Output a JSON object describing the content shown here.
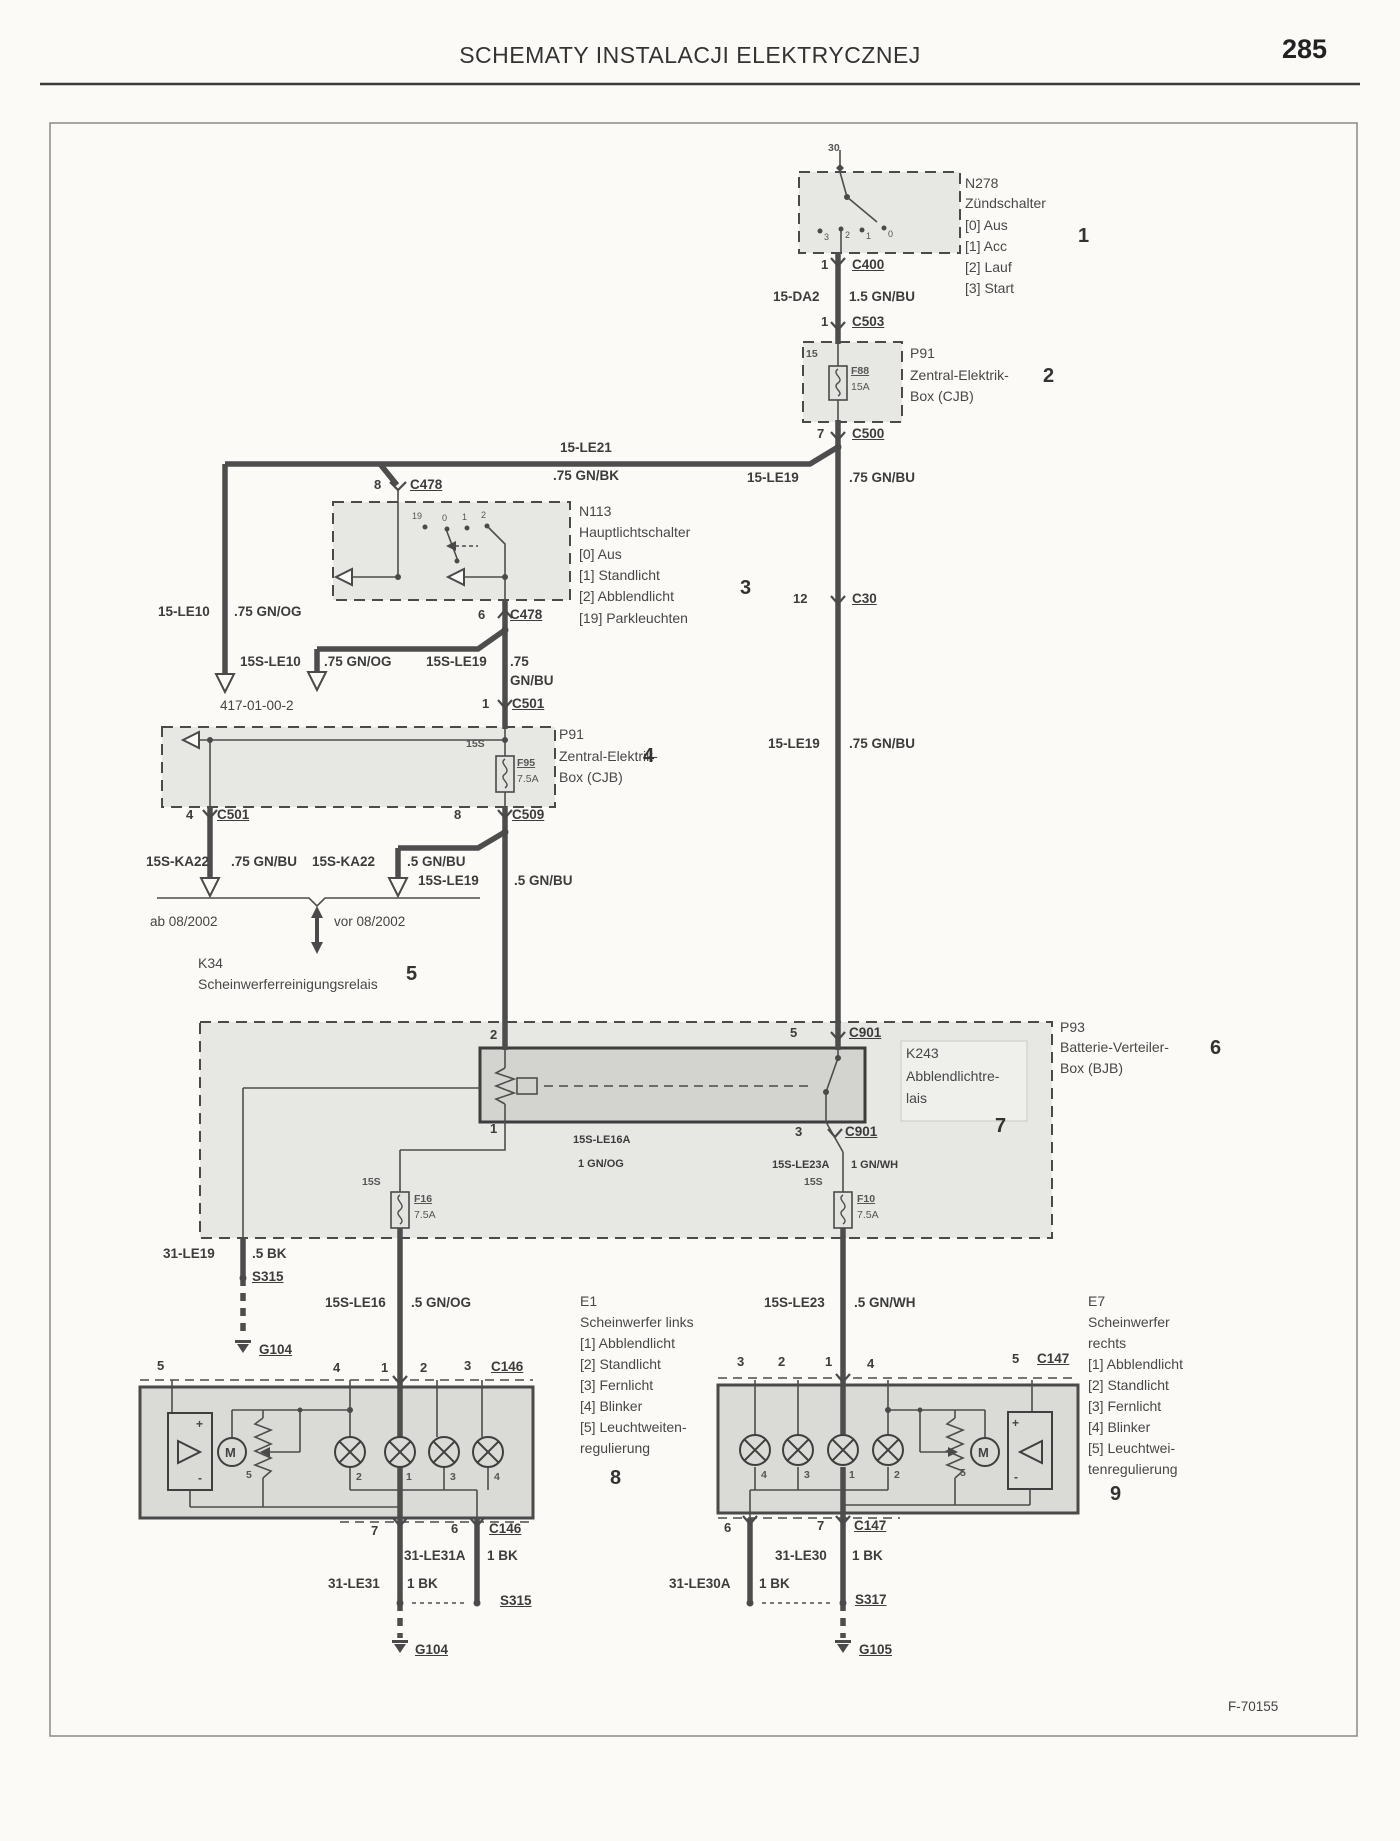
{
  "labels": {
    "header": [
      {
        "t": "SCHEMATY INSTALACJI ELEKTRYCZNEJ",
        "x": 690,
        "y": 44,
        "c": "title",
        "n": "page-header-title"
      },
      {
        "t": "285",
        "x": 1282,
        "y": 36,
        "c": "pagenum",
        "n": "page-number"
      },
      {
        "t": "F-70155",
        "x": 1228,
        "y": 1700,
        "c": "nt",
        "n": "figure-code"
      }
    ],
    "wires": [
      {
        "t": "15-DA2",
        "x": 773,
        "y": 290
      },
      {
        "t": "1.5 GN/BU",
        "x": 849,
        "y": 290
      },
      {
        "t": "15-LE21",
        "x": 560,
        "y": 441
      },
      {
        "t": ".75 GN/BK",
        "x": 553,
        "y": 469
      },
      {
        "t": "15-LE19",
        "x": 747,
        "y": 471
      },
      {
        "t": ".75 GN/BU",
        "x": 849,
        "y": 471
      },
      {
        "t": "15-LE10",
        "x": 158,
        "y": 605
      },
      {
        "t": ".75 GN/OG",
        "x": 234,
        "y": 605
      },
      {
        "t": "15S-LE10",
        "x": 240,
        "y": 655
      },
      {
        "t": ".75 GN/OG",
        "x": 324,
        "y": 655
      },
      {
        "t": "15S-LE19",
        "x": 426,
        "y": 655
      },
      {
        "t": ".75",
        "x": 510,
        "y": 655
      },
      {
        "t": "GN/BU",
        "x": 510,
        "y": 674
      },
      {
        "t": "15S-KA22",
        "x": 146,
        "y": 855
      },
      {
        "t": ".75 GN/BU",
        "x": 231,
        "y": 855
      },
      {
        "t": "15S-KA22",
        "x": 312,
        "y": 855
      },
      {
        "t": ".5 GN/BU",
        "x": 407,
        "y": 855
      },
      {
        "t": "15S-LE19",
        "x": 418,
        "y": 874
      },
      {
        "t": ".5 GN/BU",
        "x": 514,
        "y": 874
      },
      {
        "t": "15-LE19",
        "x": 768,
        "y": 737
      },
      {
        "t": ".75 GN/BU",
        "x": 849,
        "y": 737
      },
      {
        "t": "15S-LE16A",
        "x": 573,
        "y": 1135,
        "c": "wls"
      },
      {
        "t": "1 GN/OG",
        "x": 578,
        "y": 1159,
        "c": "wls"
      },
      {
        "t": "15S-LE23A",
        "x": 772,
        "y": 1160,
        "c": "wls"
      },
      {
        "t": "1 GN/WH",
        "x": 851,
        "y": 1160,
        "c": "wls"
      },
      {
        "t": "31-LE19",
        "x": 163,
        "y": 1247
      },
      {
        "t": ".5 BK",
        "x": 252,
        "y": 1247
      },
      {
        "t": "15S-LE16",
        "x": 325,
        "y": 1296
      },
      {
        "t": ".5 GN/OG",
        "x": 411,
        "y": 1296
      },
      {
        "t": "15S-LE23",
        "x": 764,
        "y": 1296
      },
      {
        "t": ".5 GN/WH",
        "x": 854,
        "y": 1296
      },
      {
        "t": "31-LE31A",
        "x": 404,
        "y": 1549
      },
      {
        "t": "1 BK",
        "x": 487,
        "y": 1549
      },
      {
        "t": "31-LE31",
        "x": 328,
        "y": 1577
      },
      {
        "t": "1 BK",
        "x": 407,
        "y": 1577
      },
      {
        "t": "31-LE30",
        "x": 775,
        "y": 1549
      },
      {
        "t": "1 BK",
        "x": 852,
        "y": 1549
      },
      {
        "t": "31-LE30A",
        "x": 669,
        "y": 1577
      },
      {
        "t": "1 BK",
        "x": 759,
        "y": 1577
      }
    ],
    "connectors": [
      {
        "t": "C400",
        "x": 852,
        "y": 258
      },
      {
        "t": "C503",
        "x": 852,
        "y": 315
      },
      {
        "t": "C500",
        "x": 852,
        "y": 427
      },
      {
        "t": "C478",
        "x": 410,
        "y": 478
      },
      {
        "t": "C478",
        "x": 510,
        "y": 608
      },
      {
        "t": "C501",
        "x": 512,
        "y": 697
      },
      {
        "t": "C501",
        "x": 217,
        "y": 808
      },
      {
        "t": "C509",
        "x": 512,
        "y": 808
      },
      {
        "t": "C30",
        "x": 852,
        "y": 592
      },
      {
        "t": "C901",
        "x": 849,
        "y": 1026
      },
      {
        "t": "C901",
        "x": 845,
        "y": 1125
      },
      {
        "t": "C146",
        "x": 491,
        "y": 1360
      },
      {
        "t": "C146",
        "x": 489,
        "y": 1522
      },
      {
        "t": "C147",
        "x": 1037,
        "y": 1352
      },
      {
        "t": "C147",
        "x": 854,
        "y": 1519
      },
      {
        "t": "S315",
        "x": 252,
        "y": 1270
      },
      {
        "t": "S315",
        "x": 500,
        "y": 1594
      },
      {
        "t": "S317",
        "x": 855,
        "y": 1593
      },
      {
        "t": "G104",
        "x": 259,
        "y": 1343
      },
      {
        "t": "G104",
        "x": 415,
        "y": 1643
      },
      {
        "t": "G105",
        "x": 859,
        "y": 1643
      }
    ],
    "pins": [
      {
        "t": "1",
        "x": 821,
        "y": 258
      },
      {
        "t": "1",
        "x": 821,
        "y": 315
      },
      {
        "t": "7",
        "x": 817,
        "y": 427
      },
      {
        "t": "8",
        "x": 374,
        "y": 478
      },
      {
        "t": "6",
        "x": 478,
        "y": 608
      },
      {
        "t": "1",
        "x": 482,
        "y": 697
      },
      {
        "t": "4",
        "x": 186,
        "y": 808
      },
      {
        "t": "8",
        "x": 454,
        "y": 808
      },
      {
        "t": "12",
        "x": 793,
        "y": 592
      },
      {
        "t": "5",
        "x": 790,
        "y": 1026
      },
      {
        "t": "3",
        "x": 795,
        "y": 1125
      },
      {
        "t": "2",
        "x": 490,
        "y": 1028
      },
      {
        "t": "1",
        "x": 490,
        "y": 1122
      },
      {
        "t": "5",
        "x": 157,
        "y": 1359
      },
      {
        "t": "4",
        "x": 333,
        "y": 1361
      },
      {
        "t": "1",
        "x": 381,
        "y": 1361
      },
      {
        "t": "2",
        "x": 420,
        "y": 1361
      },
      {
        "t": "3",
        "x": 464,
        "y": 1359
      },
      {
        "t": "7",
        "x": 371,
        "y": 1524
      },
      {
        "t": "6",
        "x": 451,
        "y": 1522
      },
      {
        "t": "3",
        "x": 737,
        "y": 1355
      },
      {
        "t": "2",
        "x": 778,
        "y": 1355
      },
      {
        "t": "1",
        "x": 825,
        "y": 1355
      },
      {
        "t": "4",
        "x": 867,
        "y": 1357
      },
      {
        "t": "5",
        "x": 1012,
        "y": 1352
      },
      {
        "t": "6",
        "x": 724,
        "y": 1521
      },
      {
        "t": "7",
        "x": 817,
        "y": 1519
      }
    ],
    "fuses": [
      {
        "t": "F88",
        "x": 851,
        "y": 366
      },
      {
        "t": "15A",
        "x": 851,
        "y": 382,
        "c": "fz2"
      },
      {
        "t": "F95",
        "x": 517,
        "y": 758
      },
      {
        "t": "7.5A",
        "x": 517,
        "y": 774,
        "c": "fz2"
      },
      {
        "t": "F16",
        "x": 414,
        "y": 1194
      },
      {
        "t": "7.5A",
        "x": 414,
        "y": 1210,
        "c": "fz2"
      },
      {
        "t": "F10",
        "x": 857,
        "y": 1194
      },
      {
        "t": "7.5A",
        "x": 857,
        "y": 1210,
        "c": "fz2"
      }
    ],
    "small": [
      {
        "t": "30",
        "x": 828,
        "y": 143
      },
      {
        "t": "15",
        "x": 806,
        "y": 349
      },
      {
        "t": "15S",
        "x": 466,
        "y": 739
      },
      {
        "t": "15S",
        "x": 362,
        "y": 1177
      },
      {
        "t": "15S",
        "x": 804,
        "y": 1177
      }
    ],
    "positions": [
      {
        "t": "3",
        "x": 824,
        "y": 233
      },
      {
        "t": "2",
        "x": 845,
        "y": 231
      },
      {
        "t": "1",
        "x": 866,
        "y": 232
      },
      {
        "t": "0",
        "x": 888,
        "y": 230
      },
      {
        "t": "19",
        "x": 412,
        "y": 512
      },
      {
        "t": "0",
        "x": 442,
        "y": 514
      },
      {
        "t": "1",
        "x": 462,
        "y": 513
      },
      {
        "t": "2",
        "x": 481,
        "y": 511
      }
    ],
    "lamps": [
      {
        "t": "2",
        "x": 356,
        "y": 1472
      },
      {
        "t": "1",
        "x": 406,
        "y": 1472
      },
      {
        "t": "3",
        "x": 450,
        "y": 1472
      },
      {
        "t": "4",
        "x": 494,
        "y": 1472
      },
      {
        "t": "4",
        "x": 761,
        "y": 1470
      },
      {
        "t": "3",
        "x": 804,
        "y": 1470
      },
      {
        "t": "1",
        "x": 849,
        "y": 1470
      },
      {
        "t": "2",
        "x": 894,
        "y": 1470
      },
      {
        "t": "5",
        "x": 246,
        "y": 1470
      },
      {
        "t": "5",
        "x": 960,
        "y": 1468
      }
    ],
    "marks": [
      {
        "t": "M",
        "x": 225,
        "y": 1446,
        "c": "mm"
      },
      {
        "t": "M",
        "x": 978,
        "y": 1446,
        "c": "mm"
      },
      {
        "t": "+",
        "x": 196,
        "y": 1418
      },
      {
        "t": "-",
        "x": 198,
        "y": 1472
      },
      {
        "t": "+",
        "x": 1012,
        "y": 1417
      },
      {
        "t": "-",
        "x": 1014,
        "y": 1471
      }
    ],
    "components": [
      {
        "t": "N278",
        "x": 965,
        "y": 176
      },
      {
        "t": "Zündschalter",
        "x": 965,
        "y": 196
      },
      {
        "t": "[0] Aus",
        "x": 965,
        "y": 218
      },
      {
        "t": "[1] Acc",
        "x": 965,
        "y": 239
      },
      {
        "t": "[2] Lauf",
        "x": 965,
        "y": 260
      },
      {
        "t": "[3] Start",
        "x": 965,
        "y": 281
      },
      {
        "t": "P91",
        "x": 910,
        "y": 346
      },
      {
        "t": "Zentral-Elektrik-",
        "x": 910,
        "y": 368
      },
      {
        "t": "Box (CJB)",
        "x": 910,
        "y": 389
      },
      {
        "t": "N113",
        "x": 579,
        "y": 504
      },
      {
        "t": "Hauptlichtschalter",
        "x": 579,
        "y": 525
      },
      {
        "t": "[0] Aus",
        "x": 579,
        "y": 547
      },
      {
        "t": "[1] Standlicht",
        "x": 579,
        "y": 568
      },
      {
        "t": "[2] Abblendlicht",
        "x": 579,
        "y": 589
      },
      {
        "t": "[19] Parkleuchten",
        "x": 579,
        "y": 611
      },
      {
        "t": "P91",
        "x": 559,
        "y": 727
      },
      {
        "t": "Zentral-Elektrik-",
        "x": 559,
        "y": 749
      },
      {
        "t": "Box (CJB)",
        "x": 559,
        "y": 770
      },
      {
        "t": "K34",
        "x": 198,
        "y": 956
      },
      {
        "t": "Scheinwerferreinigungsrelais",
        "x": 198,
        "y": 977
      },
      {
        "t": "P93",
        "x": 1060,
        "y": 1020
      },
      {
        "t": "Batterie-Verteiler-",
        "x": 1060,
        "y": 1040
      },
      {
        "t": "Box (BJB)",
        "x": 1060,
        "y": 1061
      },
      {
        "t": "K243",
        "x": 906,
        "y": 1046
      },
      {
        "t": "Abblendlichtre-",
        "x": 906,
        "y": 1069
      },
      {
        "t": "lais",
        "x": 906,
        "y": 1091
      },
      {
        "t": "E1",
        "x": 580,
        "y": 1294
      },
      {
        "t": "Scheinwerfer links",
        "x": 580,
        "y": 1315
      },
      {
        "t": "[1] Abblendlicht",
        "x": 580,
        "y": 1336
      },
      {
        "t": "[2] Standlicht",
        "x": 580,
        "y": 1357
      },
      {
        "t": "[3] Fernlicht",
        "x": 580,
        "y": 1378
      },
      {
        "t": "[4] Blinker",
        "x": 580,
        "y": 1399
      },
      {
        "t": "[5] Leuchtweiten-",
        "x": 580,
        "y": 1420
      },
      {
        "t": "regulierung",
        "x": 580,
        "y": 1441
      },
      {
        "t": "E7",
        "x": 1088,
        "y": 1294
      },
      {
        "t": "Scheinwerfer",
        "x": 1088,
        "y": 1315
      },
      {
        "t": "rechts",
        "x": 1088,
        "y": 1336
      },
      {
        "t": "[1] Abblendlicht",
        "x": 1088,
        "y": 1357
      },
      {
        "t": "[2] Standlicht",
        "x": 1088,
        "y": 1378
      },
      {
        "t": "[3] Fernlicht",
        "x": 1088,
        "y": 1399
      },
      {
        "t": "[4] Blinker",
        "x": 1088,
        "y": 1420
      },
      {
        "t": "[5] Leuchtwei-",
        "x": 1088,
        "y": 1441
      },
      {
        "t": "tenregulierung",
        "x": 1088,
        "y": 1462
      }
    ],
    "items": [
      {
        "t": "1",
        "x": 1078,
        "y": 226
      },
      {
        "t": "2",
        "x": 1043,
        "y": 366
      },
      {
        "t": "3",
        "x": 740,
        "y": 578
      },
      {
        "t": "4",
        "x": 643,
        "y": 746
      },
      {
        "t": "5",
        "x": 406,
        "y": 964
      },
      {
        "t": "6",
        "x": 1210,
        "y": 1038
      },
      {
        "t": "7",
        "x": 995,
        "y": 1116
      },
      {
        "t": "8",
        "x": 610,
        "y": 1468
      },
      {
        "t": "9",
        "x": 1110,
        "y": 1484
      }
    ],
    "notes": [
      {
        "t": "417-01-00-2",
        "x": 220,
        "y": 699
      },
      {
        "t": "ab 08/2002",
        "x": 150,
        "y": 915
      },
      {
        "t": "vor 08/2002",
        "x": 334,
        "y": 915
      }
    ]
  }
}
